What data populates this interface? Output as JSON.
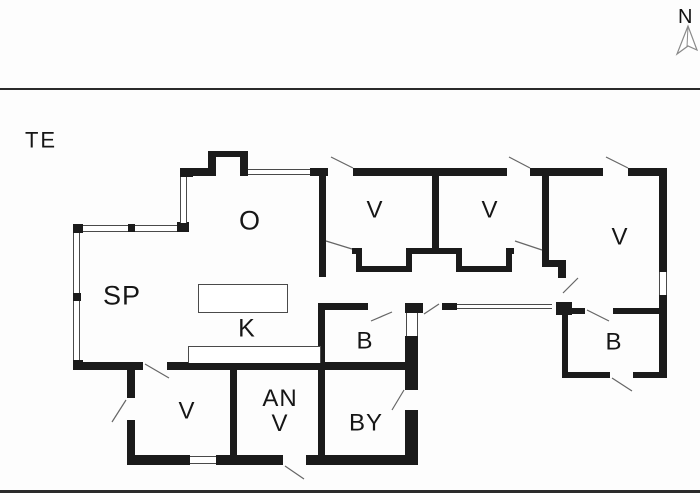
{
  "compass": {
    "label": "N"
  },
  "plan": {
    "area_label": "TE"
  },
  "rooms": {
    "living": {
      "label": "O"
    },
    "dining": {
      "label": "SP"
    },
    "kitchen": {
      "label": "K"
    },
    "bedroom1": {
      "label": "V"
    },
    "bedroom2": {
      "label": "V"
    },
    "bedroom3": {
      "label": "V"
    },
    "bath1": {
      "label": "B"
    },
    "bath2": {
      "label": "B"
    },
    "utility": {
      "label": "BY"
    },
    "bedroom4": {
      "label": "V"
    },
    "annex": {
      "line1": "AN",
      "line2": "V"
    }
  },
  "colors": {
    "wall": "#1b1b1b",
    "thin_line": "#4a4a4a",
    "door_swing": "#666666",
    "text": "#161616",
    "background": "#fdfdfd"
  }
}
